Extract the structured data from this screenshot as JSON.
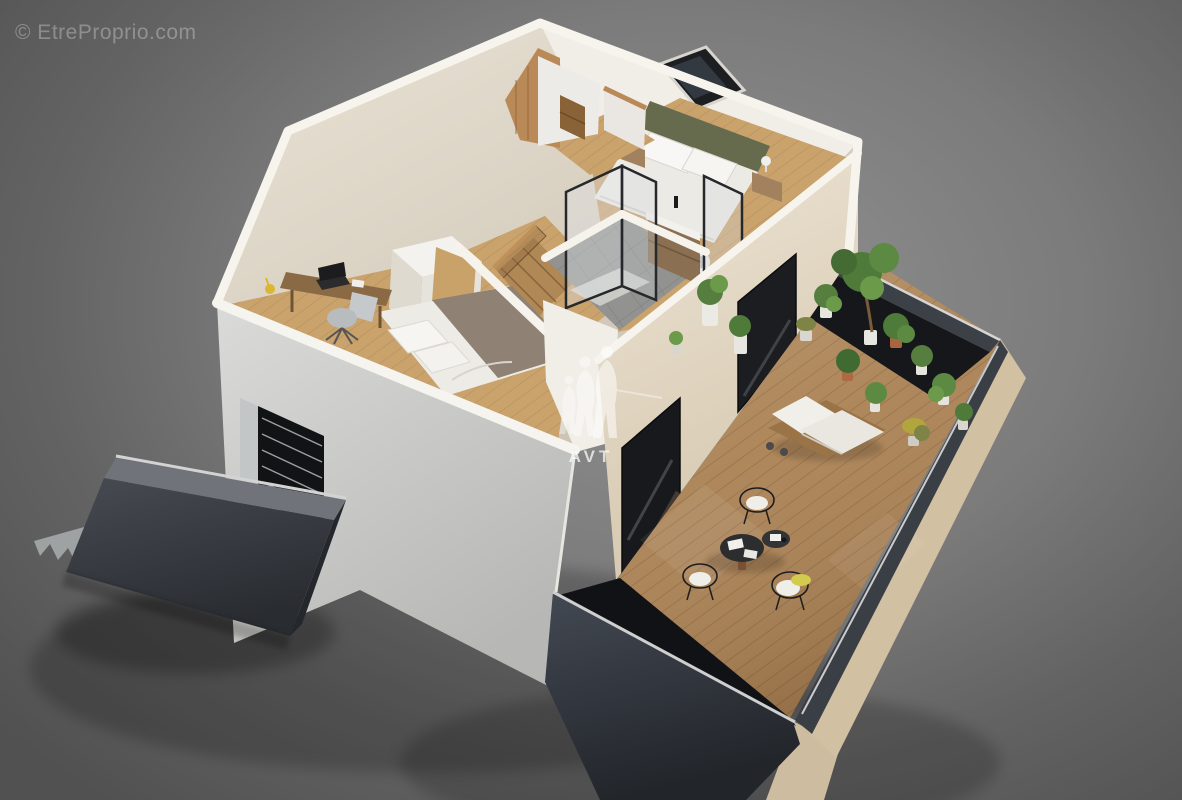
{
  "watermarks": {
    "top_left": "© EtreProprio.com",
    "center_logo": "AVT"
  },
  "scene": {
    "type": "3d-cutaway-floorplan-render",
    "areas": [
      "attic-bedroom-with-skylight",
      "office-bedroom",
      "bathroom-with-shower",
      "dressing-wardrobe",
      "staircase",
      "hallway",
      "roof-terrace-deck",
      "left-french-balcony"
    ],
    "furnishings": [
      "double-bed-olive-headboard",
      "nightstands-with-lamps",
      "double-bed-taupe-throw",
      "desk-with-laptop",
      "office-chair",
      "glass-shower-enclosure",
      "wood-vanity-sink",
      "washing-machine",
      "sun-lounger",
      "bistro-table-set",
      "wire-chairs",
      "potted-plants",
      "small-tree",
      "yellow-cushion"
    ]
  },
  "palette": {
    "background_center": "#929292",
    "background_edge": "#515151",
    "wall_cream": "#eae3d5",
    "wall_cut_white": "#f7f4ee",
    "facade_gray": "#d2d3d1",
    "wood_floor": "#c59e68",
    "deck_wood": "#aa8154",
    "anthracite": "#2e3339",
    "glass_dark": "#17191c",
    "plant_green": "#5d8a43",
    "headboard_olive": "#666b4d",
    "accent_yellow": "#d3cb4e",
    "terracotta": "#a9653f"
  }
}
